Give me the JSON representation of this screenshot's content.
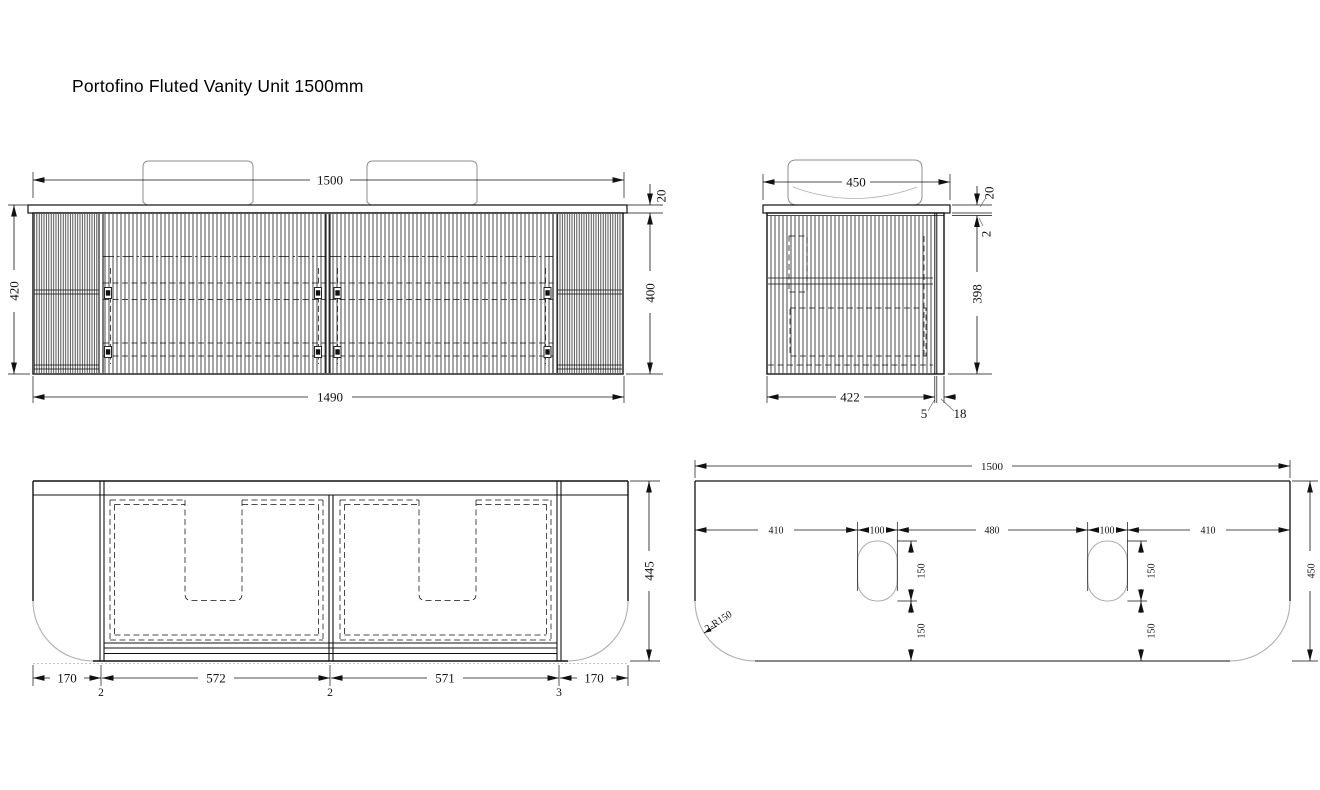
{
  "title": "Portofino Fluted Vanity Unit 1500mm",
  "colors": {
    "ink": "#111111",
    "light_gray": "#b0b0b0",
    "background": "#ffffff"
  },
  "views": {
    "front": {
      "label": "front elevation",
      "dims": {
        "overall_width": "1500",
        "overall_height": "420",
        "top_thickness": "20",
        "cabinet_height": "400",
        "cabinet_width": "1490"
      }
    },
    "side": {
      "label": "side section",
      "dims": {
        "depth": "450",
        "top_thickness": "20",
        "top_gap": "2",
        "cabinet_height": "398",
        "cabinet_depth": "422",
        "back_gap": "5",
        "back_panel": "18"
      }
    },
    "back": {
      "label": "carcass elevation",
      "dims": {
        "height": "445",
        "left_overhang": "170",
        "left_gap": "2",
        "left_door": "572",
        "mid_gap": "2",
        "right_door": "571",
        "right_gap": "3",
        "right_overhang": "170"
      }
    },
    "plan": {
      "label": "top plan",
      "dims": {
        "overall_width": "1500",
        "left_offset": "410",
        "left_hole_width": "100",
        "center_span": "480",
        "right_hole_width": "100",
        "right_offset": "410",
        "left_hole_depth": "150",
        "left_hole_rear": "150",
        "right_hole_depth": "150",
        "right_hole_rear": "150",
        "depth": "450",
        "corner_radius": "2-R150"
      }
    }
  }
}
